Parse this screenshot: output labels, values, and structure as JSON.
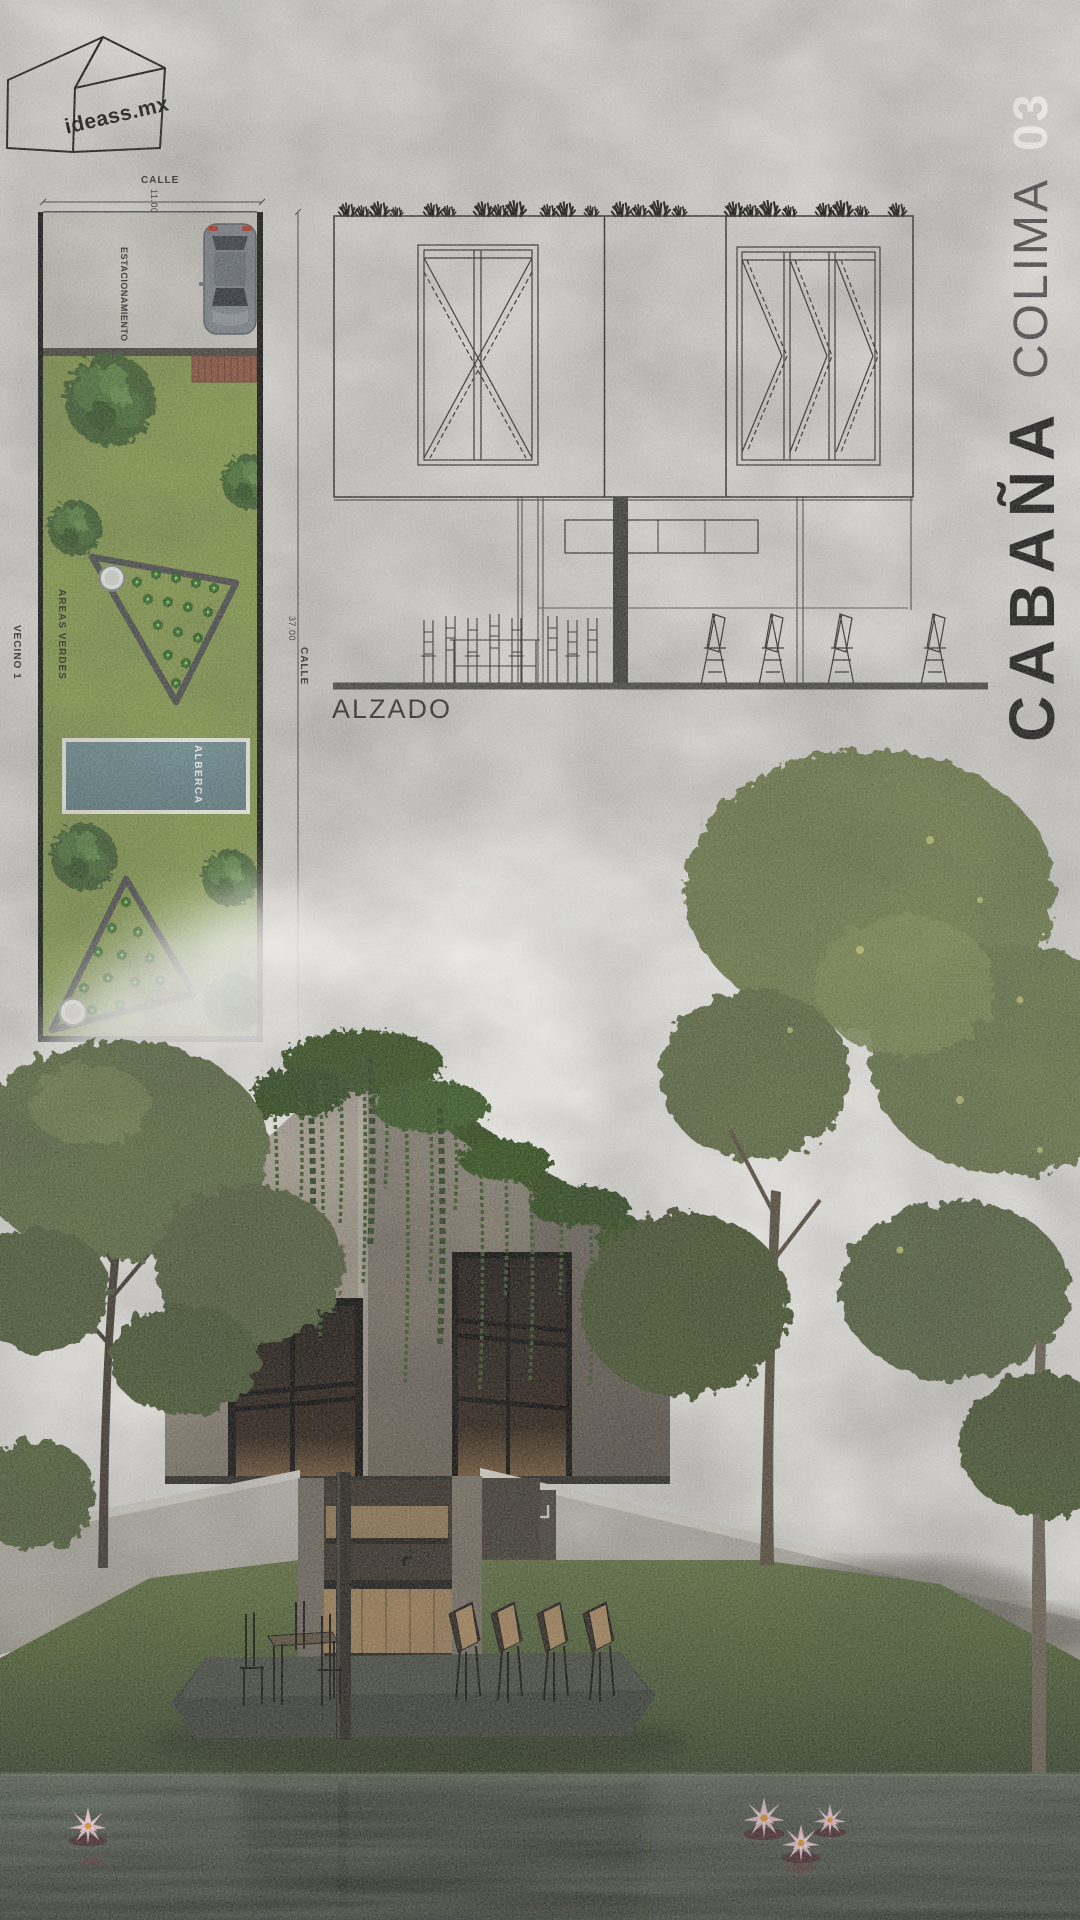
{
  "logo": {
    "brand": "ideass.mx"
  },
  "title": {
    "name": "CABAÑA",
    "location": "COLIMA",
    "number": "03"
  },
  "site_plan": {
    "street_top": "CALLE",
    "width_dim": "11.00",
    "parking": "ESTACIONAMIENTO",
    "green_areas": "AREAS VERDES",
    "neighbor_1": "VECINO 1",
    "pool": "ALBERCA",
    "depth_dim": "37.00",
    "street_right": "CALLE",
    "neighbor_2": "VECINO 2"
  },
  "elevation": {
    "label": "ALZADO"
  },
  "colors": {
    "plan_grass": "#8ba052",
    "pool_water": "#5a7d83",
    "path_grey": "#4d4d4d",
    "title_black": "#1b1b1a",
    "title_grey": "#4d4d4d",
    "title_white": "#fafaf7",
    "ivy_green": "#35511f",
    "pond": "#262b20"
  }
}
